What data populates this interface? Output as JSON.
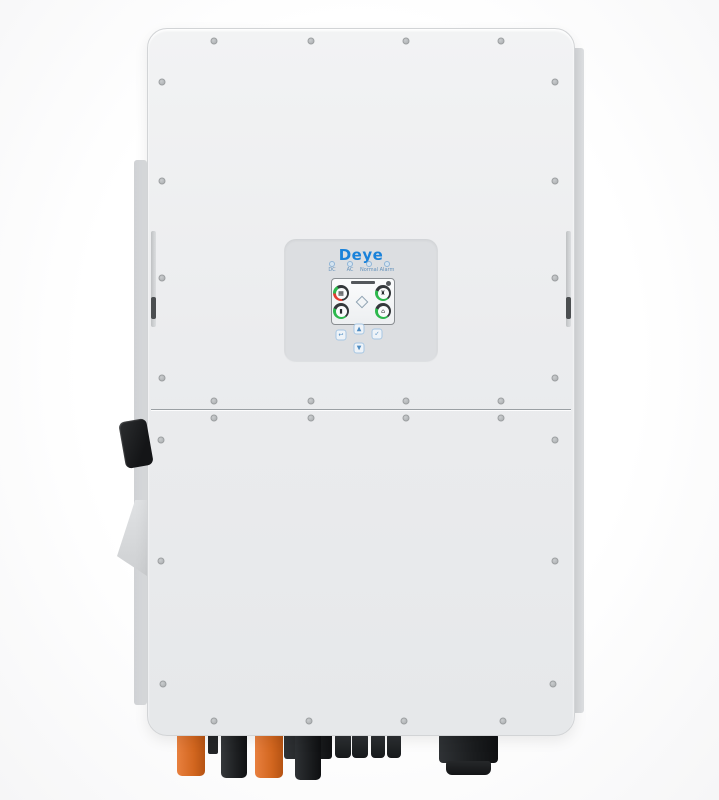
{
  "product": {
    "brand": "Deye"
  },
  "colors": {
    "brand_blue": "#1a82da",
    "body_gray": "#ebecee",
    "panel_gray": "#dcdee1",
    "connector_orange": "#d2661f",
    "connector_black": "#1d1f21",
    "gauge_green": "#2db84d",
    "gauge_red": "#e23b2e"
  },
  "panel": {
    "brand": "Deye",
    "leds": [
      {
        "name": "dc-led",
        "label": "DC"
      },
      {
        "name": "ac-led",
        "label": "AC"
      },
      {
        "name": "normal-led",
        "label": "Normal"
      },
      {
        "name": "alarm-led",
        "label": "Alarm"
      }
    ],
    "screen": {
      "settings_icon": "gear-icon",
      "gauges": [
        {
          "name": "pv-gauge",
          "icon": "solar-panel-icon",
          "glyph": "▦",
          "ring": "red-green"
        },
        {
          "name": "grid-gauge",
          "icon": "grid-tower-icon",
          "glyph": "♜",
          "ring": "green"
        },
        {
          "name": "battery-gauge",
          "icon": "battery-icon",
          "glyph": "▮",
          "ring": "green"
        },
        {
          "name": "load-gauge",
          "icon": "home-icon",
          "glyph": "⌂",
          "ring": "green"
        }
      ]
    },
    "keys": [
      {
        "name": "up-button",
        "glyph": "▲"
      },
      {
        "name": "esc-button",
        "glyph": "↩"
      },
      {
        "name": "enter-button",
        "glyph": "✓"
      },
      {
        "name": "down-button",
        "glyph": "▼"
      }
    ]
  },
  "hardware": {
    "dc_switch": "dc-disconnect-switch",
    "connectors": [
      {
        "name": "battery1-positive-connector",
        "color": "#d2661f"
      },
      {
        "name": "breather-valve",
        "color": "#232527"
      },
      {
        "name": "battery1-negative-connector",
        "color": "#1d1f21"
      },
      {
        "name": "battery2-positive-connector",
        "color": "#d2661f"
      },
      {
        "name": "battery2-negative-connector",
        "color": "#1d1f21"
      },
      {
        "name": "pv-mc4-connector-pair-1",
        "color": "#1d1f21"
      },
      {
        "name": "pv-mc4-connector-pair-2",
        "color": "#1d1f21"
      },
      {
        "name": "ac-cable-gland",
        "color": "#1a1c1e"
      }
    ]
  }
}
